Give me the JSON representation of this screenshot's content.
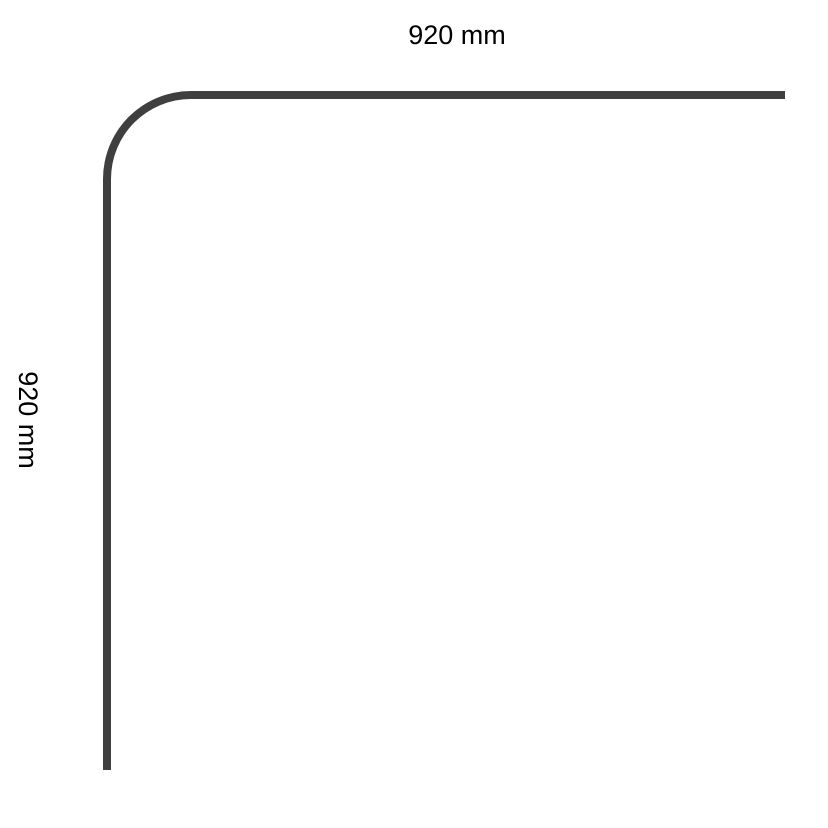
{
  "diagram": {
    "type": "corner-profile-dimension-drawing",
    "top_dimension": {
      "label": "920 mm"
    },
    "left_dimension": {
      "label": "920 mm"
    }
  },
  "colors": {
    "line": "#3f3f3f",
    "text": "#000000",
    "background": "#ffffff"
  }
}
